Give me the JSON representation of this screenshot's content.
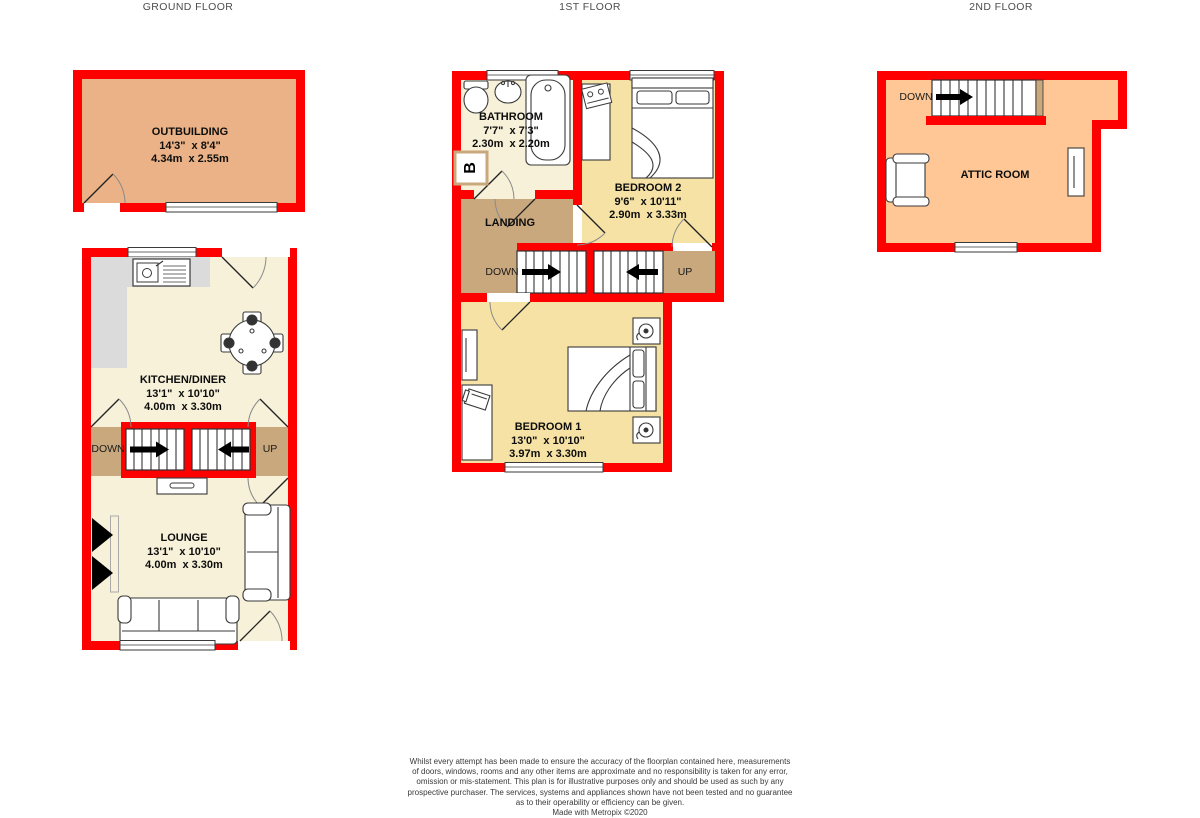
{
  "colors": {
    "wall_red": "#FE0000",
    "cream": "#F6F1D8",
    "bedroom_gold": "#F5E2A4",
    "landing_tan": "#C9A87E",
    "outbuilding_tan": "#EAB286",
    "attic_peach": "#FEC795",
    "counter_gray": "#DBDBDB"
  },
  "floors": [
    {
      "title": "GROUND FLOOR",
      "rooms": [
        {
          "name": "OUTBUILDING",
          "imperial": "14'3\"  x 8'4\"",
          "metric": "4.34m  x 2.55m"
        },
        {
          "name": "KITCHEN/DINER",
          "imperial": "13'1\"  x 10'10\"",
          "metric": "4.00m  x 3.30m"
        },
        {
          "name": "LOUNGE",
          "imperial": "13'1\"  x 10'10\"",
          "metric": "4.00m  x 3.30m"
        }
      ],
      "labels": {
        "down": "DOWN",
        "up": "UP"
      }
    },
    {
      "title": "1ST FLOOR",
      "rooms": [
        {
          "name": "BATHROOM",
          "imperial": "7'7\"  x 7'3\"",
          "metric": "2.30m  x 2.20m"
        },
        {
          "name": "LANDING"
        },
        {
          "name": "BEDROOM 2",
          "imperial": "9'6\"  x 10'11\"",
          "metric": "2.90m  x 3.33m"
        },
        {
          "name": "BEDROOM 1",
          "imperial": "13'0\"  x 10'10\"",
          "metric": "3.97m  x 3.30m"
        }
      ],
      "labels": {
        "down": "DOWN",
        "up": "UP",
        "boiler": "B"
      }
    },
    {
      "title": "2ND FLOOR",
      "rooms": [
        {
          "name": "ATTIC ROOM"
        }
      ],
      "labels": {
        "down": "DOWN"
      }
    }
  ],
  "disclaimer": {
    "lines": [
      "Whilst every attempt has been made to ensure the accuracy of the floorplan contained here, measurements",
      "of doors, windows, rooms and any other items are approximate and no responsibility is taken for any error,",
      "omission or mis-statement. This plan is for illustrative purposes only and should be used as such by any",
      "prospective purchaser. The services, systems and appliances shown have not been tested and no guarantee",
      "as to their operability or efficiency can be given.",
      "Made with Metropix ©2020"
    ]
  }
}
